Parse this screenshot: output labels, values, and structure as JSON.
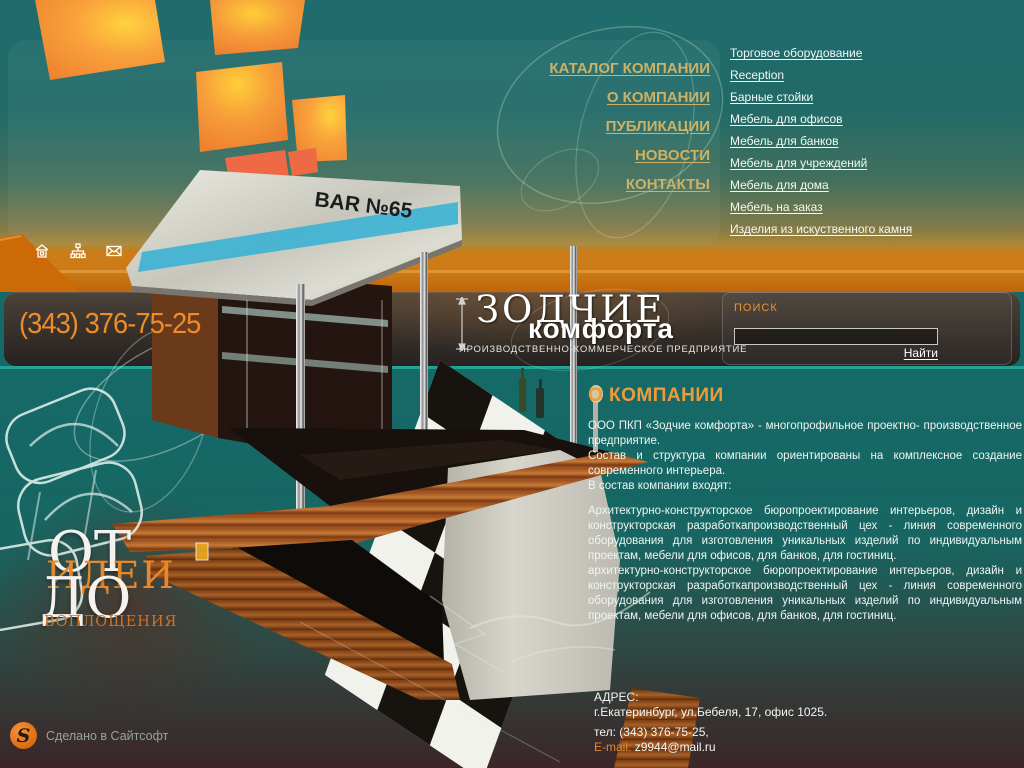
{
  "colors": {
    "accent_orange": "#ef8c28",
    "gold_nav": "#ccb266",
    "heading_orange": "#f09a3c",
    "teal_bg": "#156a68",
    "divider": "#1fa392",
    "band_orange": "#cd7a16"
  },
  "nav": {
    "items": [
      {
        "label": "КАТАЛОГ КОМПАНИИ"
      },
      {
        "label": "О КОМПАНИИ"
      },
      {
        "label": "ПУБЛИКАЦИИ"
      },
      {
        "label": "НОВОСТИ"
      },
      {
        "label": "КОНТАКТЫ"
      }
    ]
  },
  "catalog": {
    "items": [
      {
        "label": "Торговое оборудование"
      },
      {
        "label": "Reception"
      },
      {
        "label": "Барные стойки"
      },
      {
        "label": "Мебель для офисов"
      },
      {
        "label": "Мебель для банков"
      },
      {
        "label": "Мебель для учреждений"
      },
      {
        "label": "Мебель для дома"
      },
      {
        "label": "Мебель на заказ"
      },
      {
        "label": "Изделия из искуственного камня"
      }
    ]
  },
  "header": {
    "phone": "(343) 376-75-25",
    "logo": {
      "title": "ЗОДЧИЕ",
      "subtitle": "комфорта",
      "tagline": "ПРОИЗВОДСТВЕННО-КОММЕРЧЕСКОЕ ПРЕДПРИЯТИЕ"
    },
    "search": {
      "label": "ПОИСК",
      "value": "",
      "submit": "Найти"
    },
    "icons": [
      "home-icon",
      "sitemap-icon",
      "mail-icon"
    ]
  },
  "hero": {
    "bar_sign": "BAR №65",
    "slogan": {
      "w1": "ОТ",
      "w2": "ИДЕИ",
      "w3": "ДО",
      "w4": "ВОПЛОЩЕНИЯ"
    }
  },
  "about": {
    "title": "О КОМПАНИИ",
    "paragraphs": [
      "ООО ПКП «Зодчие комфорта» - многопрофильное проектно- производственное предприятие.",
      "Состав и структура компании ориентированы на комплексное создание современного интерьера.",
      "В состав компании входят:",
      "Архитектурно-конструкторское бюропроектирование интерьеров, дизайн и конструкторская разработкапроизводственный цех - линия современного оборудования для изготовления уникальных изделий по индивидуальным проектам, мебели для офисов, для банков, для гостиниц.",
      "архитектурно-конструкторское бюропроектирование интерьеров, дизайн и конструкторская разработкапроизводственный цех - линия современного оборудования для изготовления уникальных изделий по индивидуальным проектам, мебели для офисов, для банков, для гостиниц."
    ]
  },
  "contact": {
    "heading": "АДРЕС:",
    "address": "г.Екатеринбург, ул.Бебеля, 17, офис 1025.",
    "phone": "тел: (343) 376-75-25,",
    "email_label": "E-mail:",
    "email": "z9944@mail.ru"
  },
  "footer": {
    "credit": "Сделано в Сайтсофт",
    "logo_letter": "S"
  }
}
